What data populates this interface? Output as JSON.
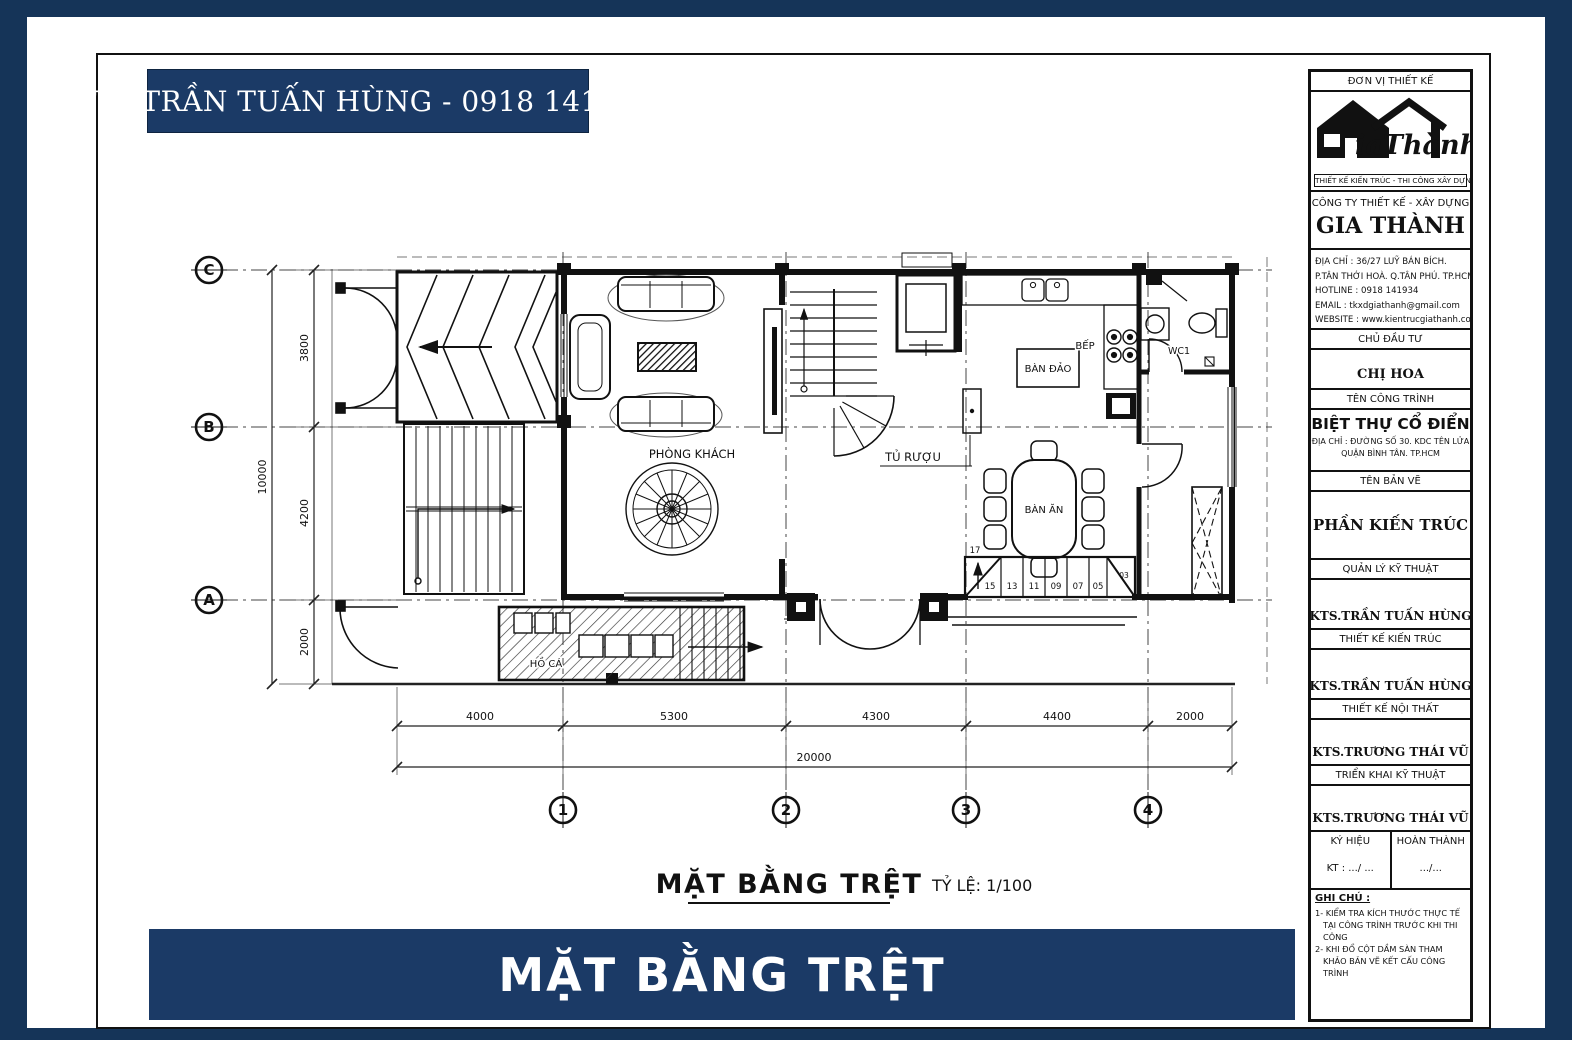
{
  "colors": {
    "navy": "#1b3a66",
    "background": "#153458",
    "ink": "#111111"
  },
  "top_banner": {
    "text": "KTS.TRẦN TUẤN HÙNG - 0918 1419 34"
  },
  "bottom_banner": {
    "text": "MẶT BẰNG TRỆT"
  },
  "plan": {
    "title": "MẶT BẰNG TRỆT",
    "scale_label": "TỶ LỆ: 1/100",
    "labels": {
      "phong_khach": "PHÒNG KHÁCH",
      "tu_ruou": "TỦ RƯỢU",
      "ban_dao": "BÀN ĐẢO",
      "bep": "BẾP",
      "wc1": "WC1",
      "ban_an": "BÀN ĂN",
      "ho_ca": "HỒ CÁ"
    },
    "grid": {
      "rows": [
        "C",
        "B",
        "A"
      ],
      "cols": [
        "1",
        "2",
        "3",
        "4"
      ]
    },
    "dims": {
      "left": [
        "3800",
        "4200",
        "2000"
      ],
      "left_total": "10000",
      "bottom": [
        "4000",
        "5300",
        "4300",
        "4400",
        "2000"
      ],
      "bottom_total": "20000"
    },
    "stairs": {
      "top": "17",
      "numbers": [
        "15",
        "13",
        "11",
        "09",
        "07",
        "05"
      ],
      "right": "03"
    }
  },
  "titleblock": {
    "unit_header": "ĐƠN VỊ THIẾT KẾ",
    "logo": {
      "wordmark": "iaThành",
      "tagline": "THIẾT KẾ KIẾN TRÚC - THI CÔNG XÂY DỰNG"
    },
    "company_type": "CÔNG TY THIẾT KẾ - XÂY DỰNG",
    "company_name": "GIA THÀNH",
    "contact": {
      "lines": [
        "ĐỊA CHỈ : 36/27 LUỸ BÁN BÍCH.",
        "  P.TÂN THỚI HOÀ. Q.TÂN PHÚ. TP.HCM",
        "HOTLINE   :      0918 141934",
        "EMAIL       :   tkxdgiathanh@gmail.com",
        "WEBSITE  :  www.kientrucgiathanh.com"
      ]
    },
    "owner_header": "CHỦ ĐẦU TƯ",
    "owner": "CHỊ HOA",
    "project_header": "TÊN CÔNG TRÌNH",
    "project_name": "BIỆT THỰ CỔ ĐIỂN",
    "project_addr1": "ĐỊA CHỈ : ĐƯỜNG SỐ 30. KDC TÊN LỬA",
    "project_addr2": "QUẬN BÌNH TÂN. TP.HCM",
    "sheet_header": "TÊN BẢN VẼ",
    "sheet_name": "PHẦN KIẾN TRÚC",
    "roles": [
      {
        "header": "QUẢN LÝ KỸ THUẬT",
        "name": "KTS.TRẦN TUẤN HÙNG"
      },
      {
        "header": "THIẾT KẾ KIẾN TRÚC",
        "name": "KTS.TRẦN TUẤN HÙNG"
      },
      {
        "header": "THIẾT KẾ NỘI THẤT",
        "name": "KTS.TRƯƠNG THÁI VŨ"
      },
      {
        "header": "TRIỂN KHAI KỸ THUẬT",
        "name": "KTS.TRƯƠNG THÁI VŨ"
      }
    ],
    "sign": {
      "col1_header": "KÝ HIỆU",
      "col2_header": "HOÀN THÀNH",
      "col1_value": "KT :   .../ ...",
      "col2_value": ".../..."
    },
    "notes_header": "GHI CHÚ :",
    "notes": [
      "1- KIỂM TRA KÍCH THƯỚC THỰC TẾ TẠI CÔNG TRÌNH TRƯỚC KHI THI CÔNG",
      "2- KHI ĐỔ CỘT DẦM SÀN THAM KHẢO BẢN VẼ KẾT CẤU CÔNG TRÌNH",
      "3- KHI XÂY TÔ ỐP GẠCH XEM KỸ BẢN VẼ TRANG TRÍ NỘI THẤT"
    ]
  }
}
